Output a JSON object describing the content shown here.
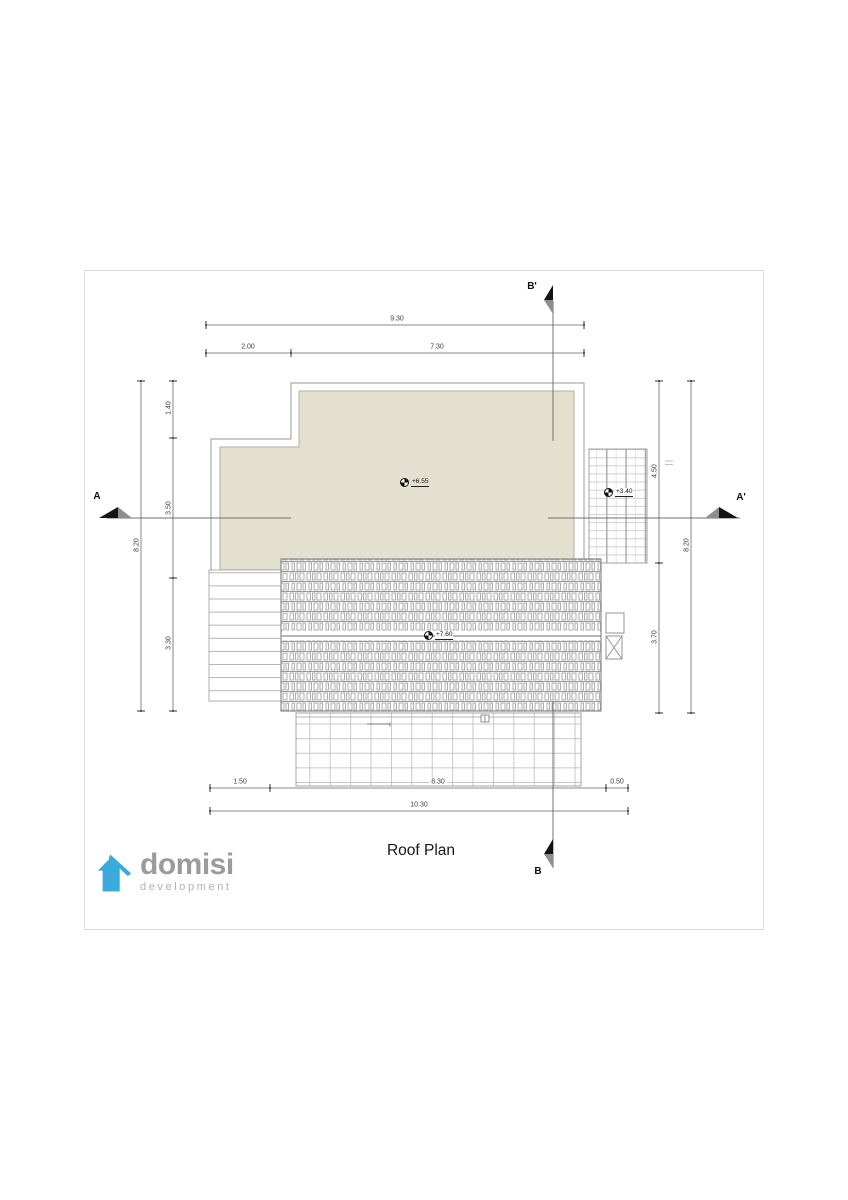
{
  "sheet": {
    "title": "Roof Plan",
    "logo": {
      "name": "domisi",
      "tagline": "development"
    },
    "sections": {
      "a": "A",
      "a_prime": "A'",
      "b": "B",
      "b_prime": "B'"
    },
    "levels": {
      "main_roof": "+6.55",
      "annex_roof": "+3.40",
      "tiled_roof": "+7.60"
    },
    "dims": {
      "top": {
        "total": "9.30",
        "seg1": "2.00",
        "seg2": "7.30"
      },
      "left": {
        "total": "8.20",
        "seg1": "1.40",
        "seg2": "3.50",
        "seg3": "3.30"
      },
      "right": {
        "total": "8.20",
        "seg1": "4.50",
        "seg2": "3.70"
      },
      "bottom": {
        "total": "10.30",
        "seg1": "1.50",
        "seg2": "8.30",
        "seg3": "0.50"
      }
    },
    "colors": {
      "roof_fill": "#E3E0CF",
      "logo_blue": "#3BA9DA"
    }
  }
}
